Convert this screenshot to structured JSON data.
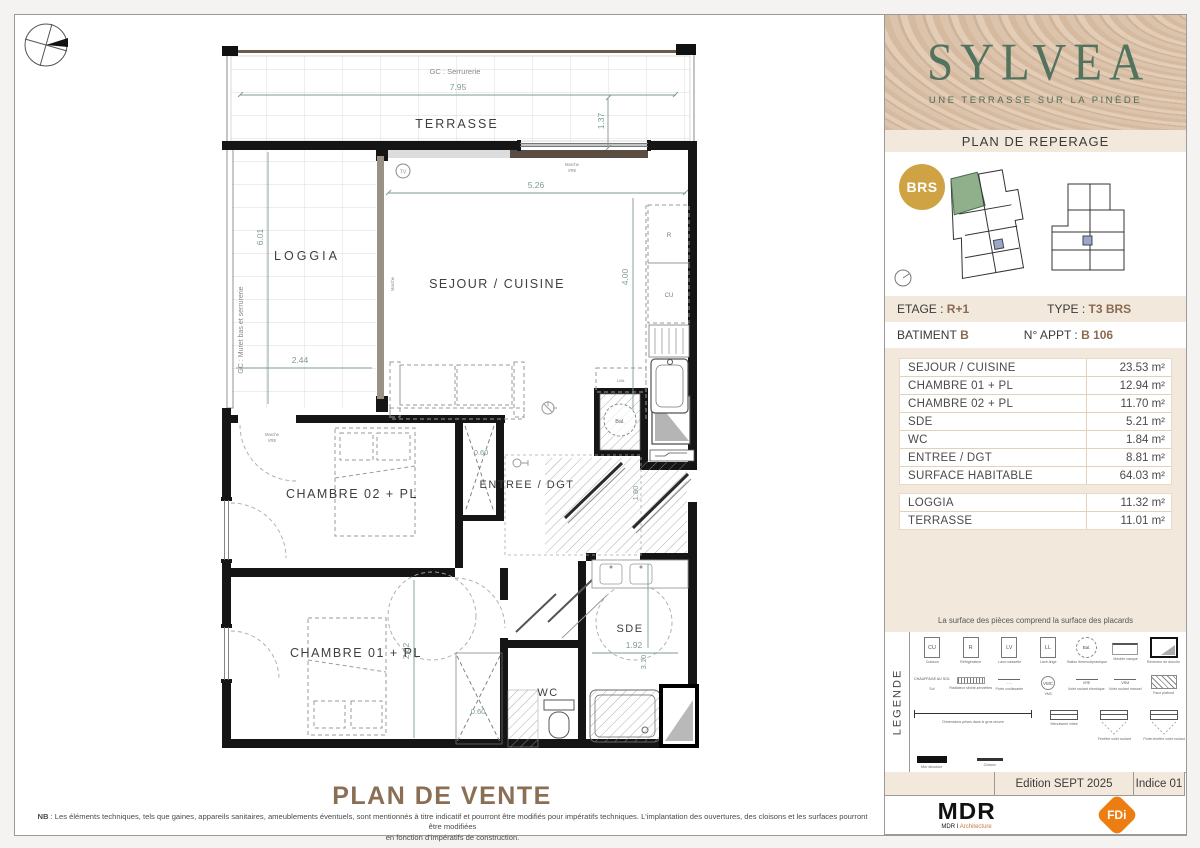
{
  "colors": {
    "cream": "#f2e9dc",
    "brand_green": "#52735e",
    "accent_brown": "#8a6a52",
    "badge_gold": "#cfa343",
    "fdi_orange": "#ee7d11",
    "unit_highlight_green": "#8fb08b",
    "dimension_green": "#7d9b8e"
  },
  "sidebar": {
    "brand": {
      "name": "SYLVEA",
      "tagline": "UNE TERRASSE SUR LA PINÈDE"
    },
    "reperage": "PLAN DE REPERAGE",
    "badge": "BRS",
    "etage": {
      "label": "ETAGE :",
      "value": "R+1"
    },
    "type": {
      "label": "TYPE :",
      "value": "T3  BRS"
    },
    "batiment": {
      "label": "BATIMENT",
      "value": "B"
    },
    "appt": {
      "label": "N° APPT :",
      "value": "B 106"
    },
    "areas": [
      {
        "label": "SEJOUR / CUISINE",
        "value": "23.53 m²"
      },
      {
        "label": "CHAMBRE 01 + PL",
        "value": "12.94 m²"
      },
      {
        "label": "CHAMBRE 02 + PL",
        "value": "11.70 m²"
      },
      {
        "label": "SDE",
        "value": "5.21 m²"
      },
      {
        "label": "WC",
        "value": "1.84 m²"
      },
      {
        "label": "ENTREE / DGT",
        "value": "8.81 m²"
      },
      {
        "label": "SURFACE HABITABLE",
        "value": "64.03 m²"
      }
    ],
    "annexes": [
      {
        "label": "LOGGIA",
        "value": "11.32 m²"
      },
      {
        "label": "TERRASSE",
        "value": "11.01 m²"
      }
    ],
    "note": "La surface des pièces comprend la surface des placards",
    "edition": "Edition SEPT 2025",
    "indice": "Indice 01",
    "logos": {
      "mdr": "MDR",
      "mdr_sub1": "MDR I ",
      "mdr_sub2": "Architecture",
      "fdi": "FDi"
    }
  },
  "legend": {
    "title": "LEGENDE",
    "row1": [
      {
        "glyph": "CU",
        "label": "Cuisson"
      },
      {
        "glyph": "R",
        "label": "Réfrigérateur"
      },
      {
        "glyph": "LV",
        "label": "Lave-vaisselle"
      },
      {
        "glyph": "LL",
        "label": "Lave-linge"
      },
      {
        "glyph": "Bal.",
        "label": "Ballon thermodynamique"
      },
      {
        "glyph": "",
        "label": "Meuble vasque"
      },
      {
        "glyph": "",
        "label": "Receveur de douche"
      }
    ],
    "row2": [
      {
        "glyph": "CHAUFFAGE AU SOL",
        "label": "Sol"
      },
      {
        "glyph": "",
        "label": "Radiateur sèche-serviettes"
      },
      {
        "glyph": "",
        "label": "Porte coulissante"
      },
      {
        "glyph": "VMC",
        "label": "VMC"
      },
      {
        "glyph": "VRE",
        "label": "Volet roulant électrique"
      },
      {
        "glyph": "VRM",
        "label": "Volet roulant manuel"
      },
      {
        "glyph": "",
        "label": "Faux plafond"
      }
    ],
    "row3": [
      {
        "label": "Dimensions prises dans le gros œuvre"
      },
      {
        "label": "Menuiserie vitrée"
      },
      {
        "label": "Fenêtre volet roulant"
      },
      {
        "label": "Porte-fenêtre volet roulant"
      }
    ],
    "row4": [
      {
        "label": "Mur structure"
      },
      {
        "label": "Cloison"
      }
    ]
  },
  "plan": {
    "title": "PLAN DE VENTE",
    "rooms": {
      "terrasse": "TERRASSE",
      "loggia": "LOGGIA",
      "sejour": "SEJOUR / CUISINE",
      "chambre02": "CHAMBRE 02 + PL",
      "chambre01": "CHAMBRE 01 + PL",
      "entree": "ENTREE / DGT",
      "sde": "SDE",
      "wc": "WC"
    },
    "dims": {
      "terrasse_w": "7.95",
      "terrasse_d": "1.37",
      "loggia_h": "6.01",
      "loggia_w": "2.44",
      "sejour_w": "5.26",
      "sejour_h": "4.00",
      "pl02": "0.60",
      "ch01_h": "2.82",
      "pl01": "0.60",
      "entree_h": "1.80",
      "sde_w": "1.92",
      "sde_h": "3.10"
    },
    "annotations": {
      "gc_serrurerie": "GC : Serrurerie",
      "gc_muret": "GC : Muret bas et serrurerie",
      "marche": "Marche",
      "vre": "VRE",
      "tv": "TV",
      "bal": "Bal.",
      "kitchen_r": "R",
      "kitchen_cu": "CU",
      "kitchen_lml": "LML"
    },
    "nb_bold": "NB",
    "nb_line1": " : Les éléments techniques, tels que gaines, appareils sanitaires, ameublements éventuels, sont mentionnés à titre indicatif et pourront être modifiés pour impératifs techniques. L'implantation des ouvertures, des cloisons et les surfaces pourront être modifiées",
    "nb_line2": "en fonction d'impératifs de construction."
  }
}
